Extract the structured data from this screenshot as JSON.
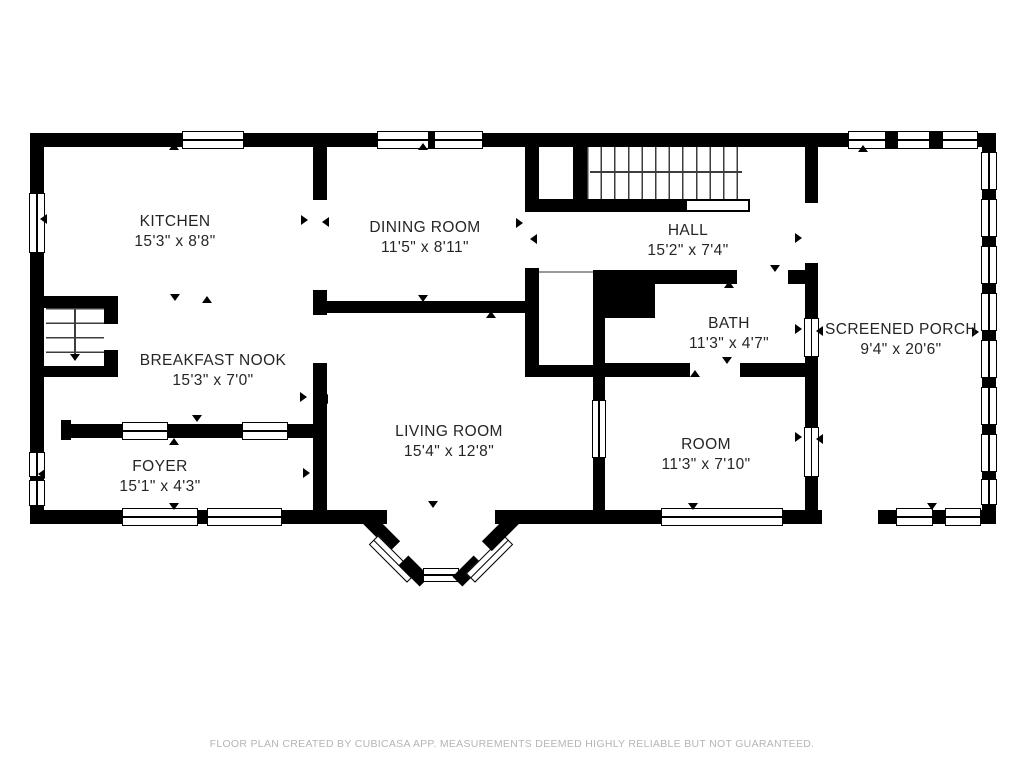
{
  "title": "Floor plan",
  "rooms": {
    "kitchen": {
      "name": "KITCHEN",
      "dimensions": "15'3\" x 8'8\""
    },
    "dining_room": {
      "name": "DINING ROOM",
      "dimensions": "11'5\" x 8'11\""
    },
    "hall": {
      "name": "HALL",
      "dimensions": "15'2\" x 7'4\""
    },
    "screened_porch": {
      "name": "SCREENED PORCH",
      "dimensions": "9'4\" x 20'6\""
    },
    "bath": {
      "name": "BATH",
      "dimensions": "11'3\" x 4'7\""
    },
    "breakfast_nook": {
      "name": "BREAKFAST NOOK",
      "dimensions": "15'3\" x 7'0\""
    },
    "living_room": {
      "name": "LIVING ROOM",
      "dimensions": "15'4\" x 12'8\""
    },
    "room": {
      "name": "ROOM",
      "dimensions": "11'3\" x 7'10\""
    },
    "foyer": {
      "name": "FOYER",
      "dimensions": "15'1\" x 4'3\""
    }
  },
  "footer": {
    "disclaimer": "FLOOR PLAN CREATED BY CUBICASA APP. MEASUREMENTS DEEMED HIGHLY RELIABLE BUT NOT GUARANTEED."
  },
  "colors": {
    "wall": "#000000",
    "background": "#ffffff",
    "label_text": "#252525",
    "footer_text": "#b5b5b5"
  }
}
